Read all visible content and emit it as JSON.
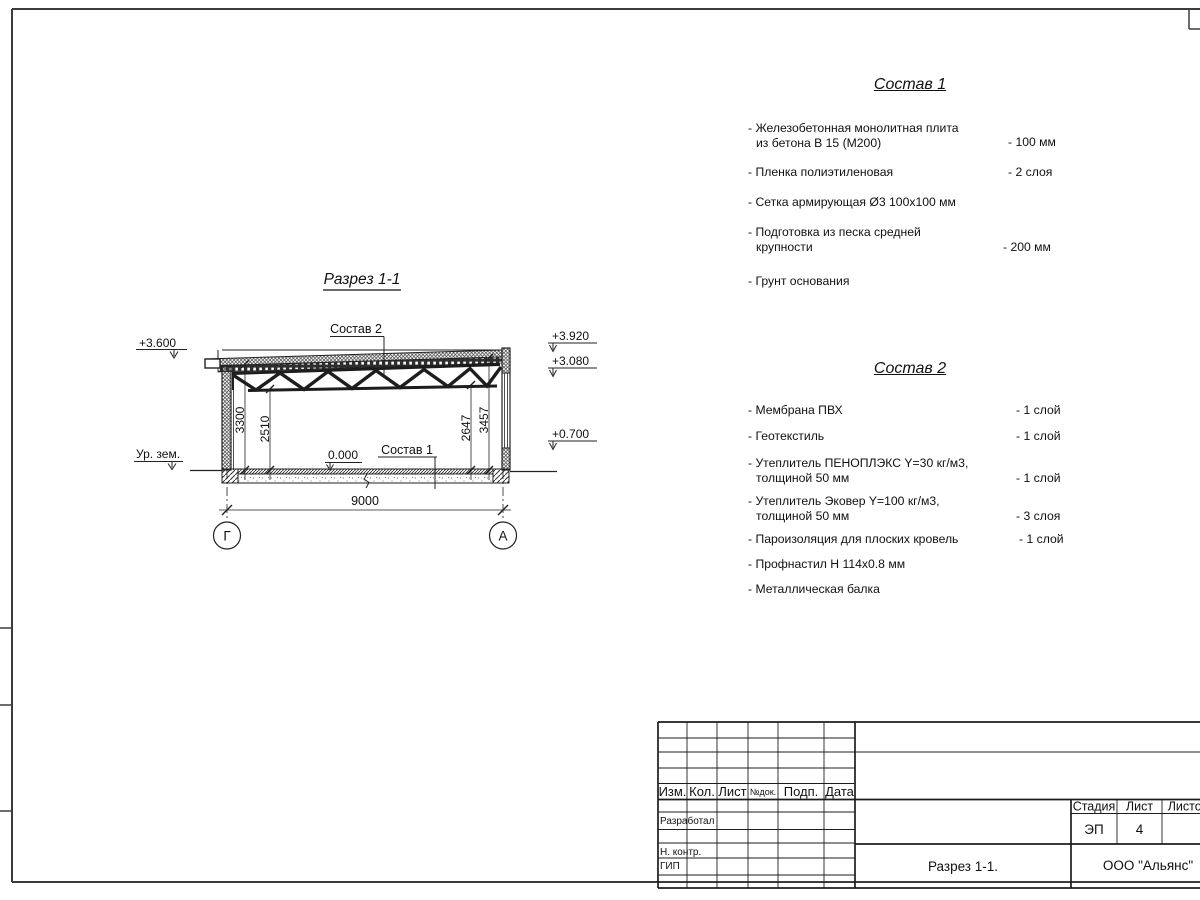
{
  "section": {
    "title": "Разрез 1-1",
    "composition2_label": "Состав 2",
    "composition1_label": "Состав 1",
    "zero_level": "0.000",
    "ground_label": "Ур. зем.",
    "elev_left": "+3.600",
    "elev_right_top": "+3.920",
    "elev_right_ceiling": "+3.080",
    "elev_right_sill": "+0.700",
    "dim_3300": "3300",
    "dim_2510": "2510",
    "dim_2647": "2647",
    "dim_3457": "3457",
    "dim_span": "9000",
    "axis_left": "Г",
    "axis_right": "А"
  },
  "comp1": {
    "title": "Состав 1",
    "items": [
      {
        "line1": "- Железобетонная  монолитная плита",
        "line2": "из бетона В 15 (М200)",
        "value": "- 100 мм"
      },
      {
        "line1": "- Пленка полиэтиленовая",
        "value": "-  2 слоя"
      },
      {
        "line1": "- Сетка армирующая Ø3 100х100 мм",
        "value": ""
      },
      {
        "line1": "- Подготовка из песка средней",
        "line2": "крупности",
        "value": "- 200 мм"
      },
      {
        "line1": "- Грунт основания",
        "value": ""
      }
    ]
  },
  "comp2": {
    "title": "Состав 2",
    "items": [
      {
        "line1": "- Мембрана ПВХ",
        "value": "- 1 слой"
      },
      {
        "line1": "- Геотекстиль",
        "value": "- 1 слой"
      },
      {
        "line1": "- Утеплитель ПЕНОПЛЭКС Y=30 кг/м3,",
        "line2": "толщиной 50 мм",
        "value": "- 1 слой"
      },
      {
        "line1": "- Утеплитель Эковер Y=100 кг/м3,",
        "line2": "толщиной 50 мм",
        "value": "- 3 слоя"
      },
      {
        "line1": "- Пароизоляция для плоских кровель",
        "value": "- 1 слой"
      },
      {
        "line1": "- Профнастил Н 114х0.8 мм",
        "value": ""
      },
      {
        "line1": "- Металлическая балка",
        "value": ""
      }
    ]
  },
  "titleblock": {
    "col_izm": "Изм.",
    "col_kol": "Кол.",
    "col_list": "Лист",
    "col_ndok": "№док.",
    "col_podp": "Подп.",
    "col_data": "Дата",
    "role_developed": "Разработал",
    "role_ncontr": "Н. контр.",
    "role_gip": "ГИП",
    "stage_label": "Стадия",
    "sheet_label": "Лист",
    "sheets_label": "Листов",
    "stage_value": "ЭП",
    "sheet_value": "4",
    "doc_title": "Разрез 1-1.",
    "company": "ООО \"Альянс\""
  }
}
